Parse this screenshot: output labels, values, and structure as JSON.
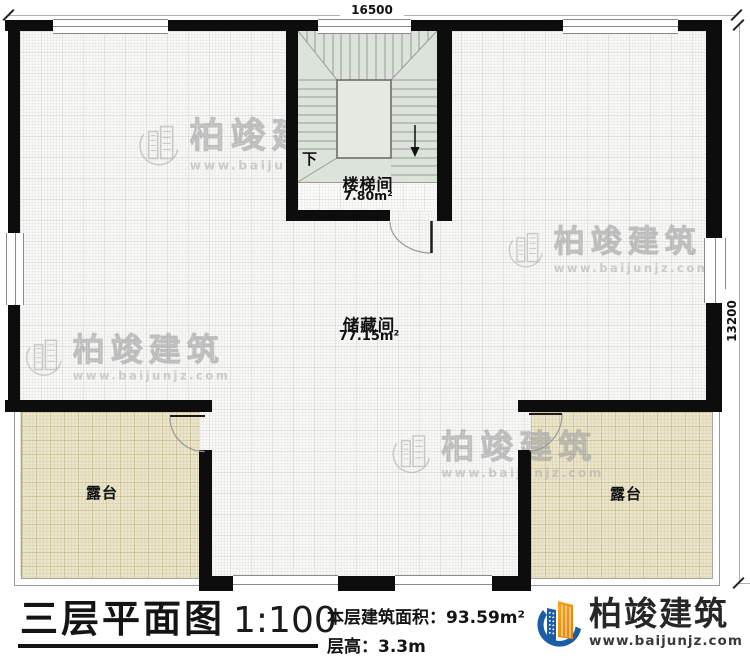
{
  "plan": {
    "dimensions": {
      "width_mm": "16500",
      "height_mm": "13200"
    },
    "rooms": {
      "staircase": {
        "name": "楼梯间",
        "area": "7.80m²",
        "down_label": "下"
      },
      "storage": {
        "name": "储藏间",
        "area": "77.15m²"
      },
      "terrace_left": {
        "name": "露台"
      },
      "terrace_right": {
        "name": "露台"
      }
    }
  },
  "title_block": {
    "title": "三层平面图",
    "scale": "1:100",
    "floor_area_label": "本层建筑面积：",
    "floor_area_value": "93.59m²",
    "floor_height_label": "层高：",
    "floor_height_value": "3.3m"
  },
  "branding": {
    "company_name": "柏竣建筑",
    "website": "www.baijunjz.com",
    "colors": {
      "logo_blue": "#1b5ea5",
      "logo_orange": "#f09a1a",
      "wall_black": "#0d0d0d",
      "stair_fill": "#dce3da",
      "terrace_fill": "#ece6cd"
    }
  },
  "watermark": {
    "text": "柏竣建筑",
    "url": "www.baijunjz.com"
  }
}
